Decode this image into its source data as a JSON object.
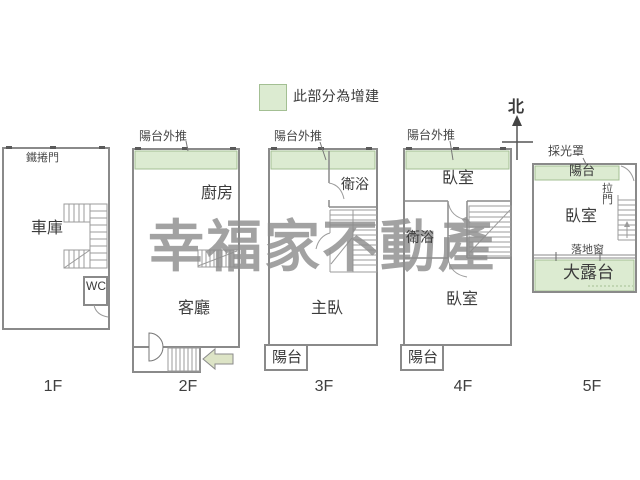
{
  "legend": {
    "text": "此部分為增建"
  },
  "compass": {
    "north_label": "北"
  },
  "watermark": {
    "text": "幸福家不動產"
  },
  "colors": {
    "wall": "#8a8a8a",
    "addition_fill": "#dcebd1",
    "addition_border": "#a3bf93",
    "arrow_fill": "#dde4c6",
    "watermark": "#8e8e8e"
  },
  "floors": {
    "f1": {
      "name": "1F",
      "rolling_door": "鐵捲門",
      "garage": "車庫",
      "wc": "WC"
    },
    "f2": {
      "name": "2F",
      "balcony_note": "陽台外推",
      "kitchen": "廚房",
      "living_room": "客廳"
    },
    "f3": {
      "name": "3F",
      "balcony_note": "陽台外推",
      "bathroom": "衛浴",
      "master_bedroom": "主臥",
      "balcony": "陽台"
    },
    "f4": {
      "name": "4F",
      "balcony_note": "陽台外推",
      "bedroom_upper": "臥室",
      "bathroom": "衛浴",
      "bedroom_lower": "臥室",
      "balcony": "陽台"
    },
    "f5": {
      "name": "5F",
      "skylight_note": "採光罩",
      "balcony": "陽台",
      "sliding_door": "拉門",
      "bedroom": "臥室",
      "french_window": "落地窗",
      "terrace": "大露台"
    }
  }
}
